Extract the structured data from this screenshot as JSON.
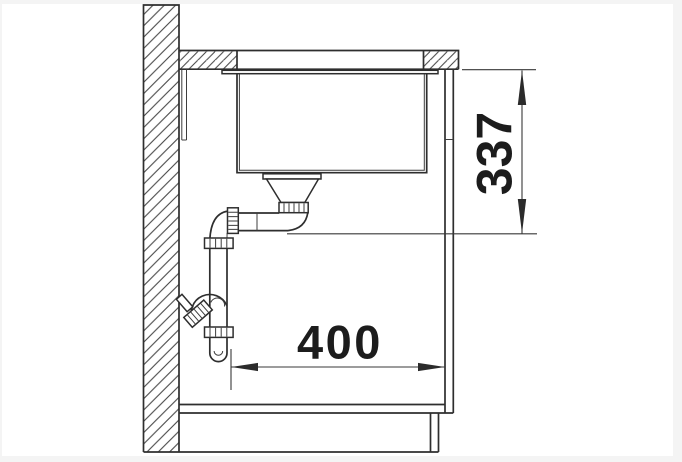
{
  "page": {
    "background_color": "#f4f4f4",
    "canvas_color": "#ffffff"
  },
  "drawing": {
    "line_color": "#2e2e2e",
    "hatch_color": "#464646",
    "text_color": "#1c1c1c"
  },
  "dimensions": {
    "height": {
      "label": "337"
    },
    "width": {
      "label": "400"
    }
  }
}
